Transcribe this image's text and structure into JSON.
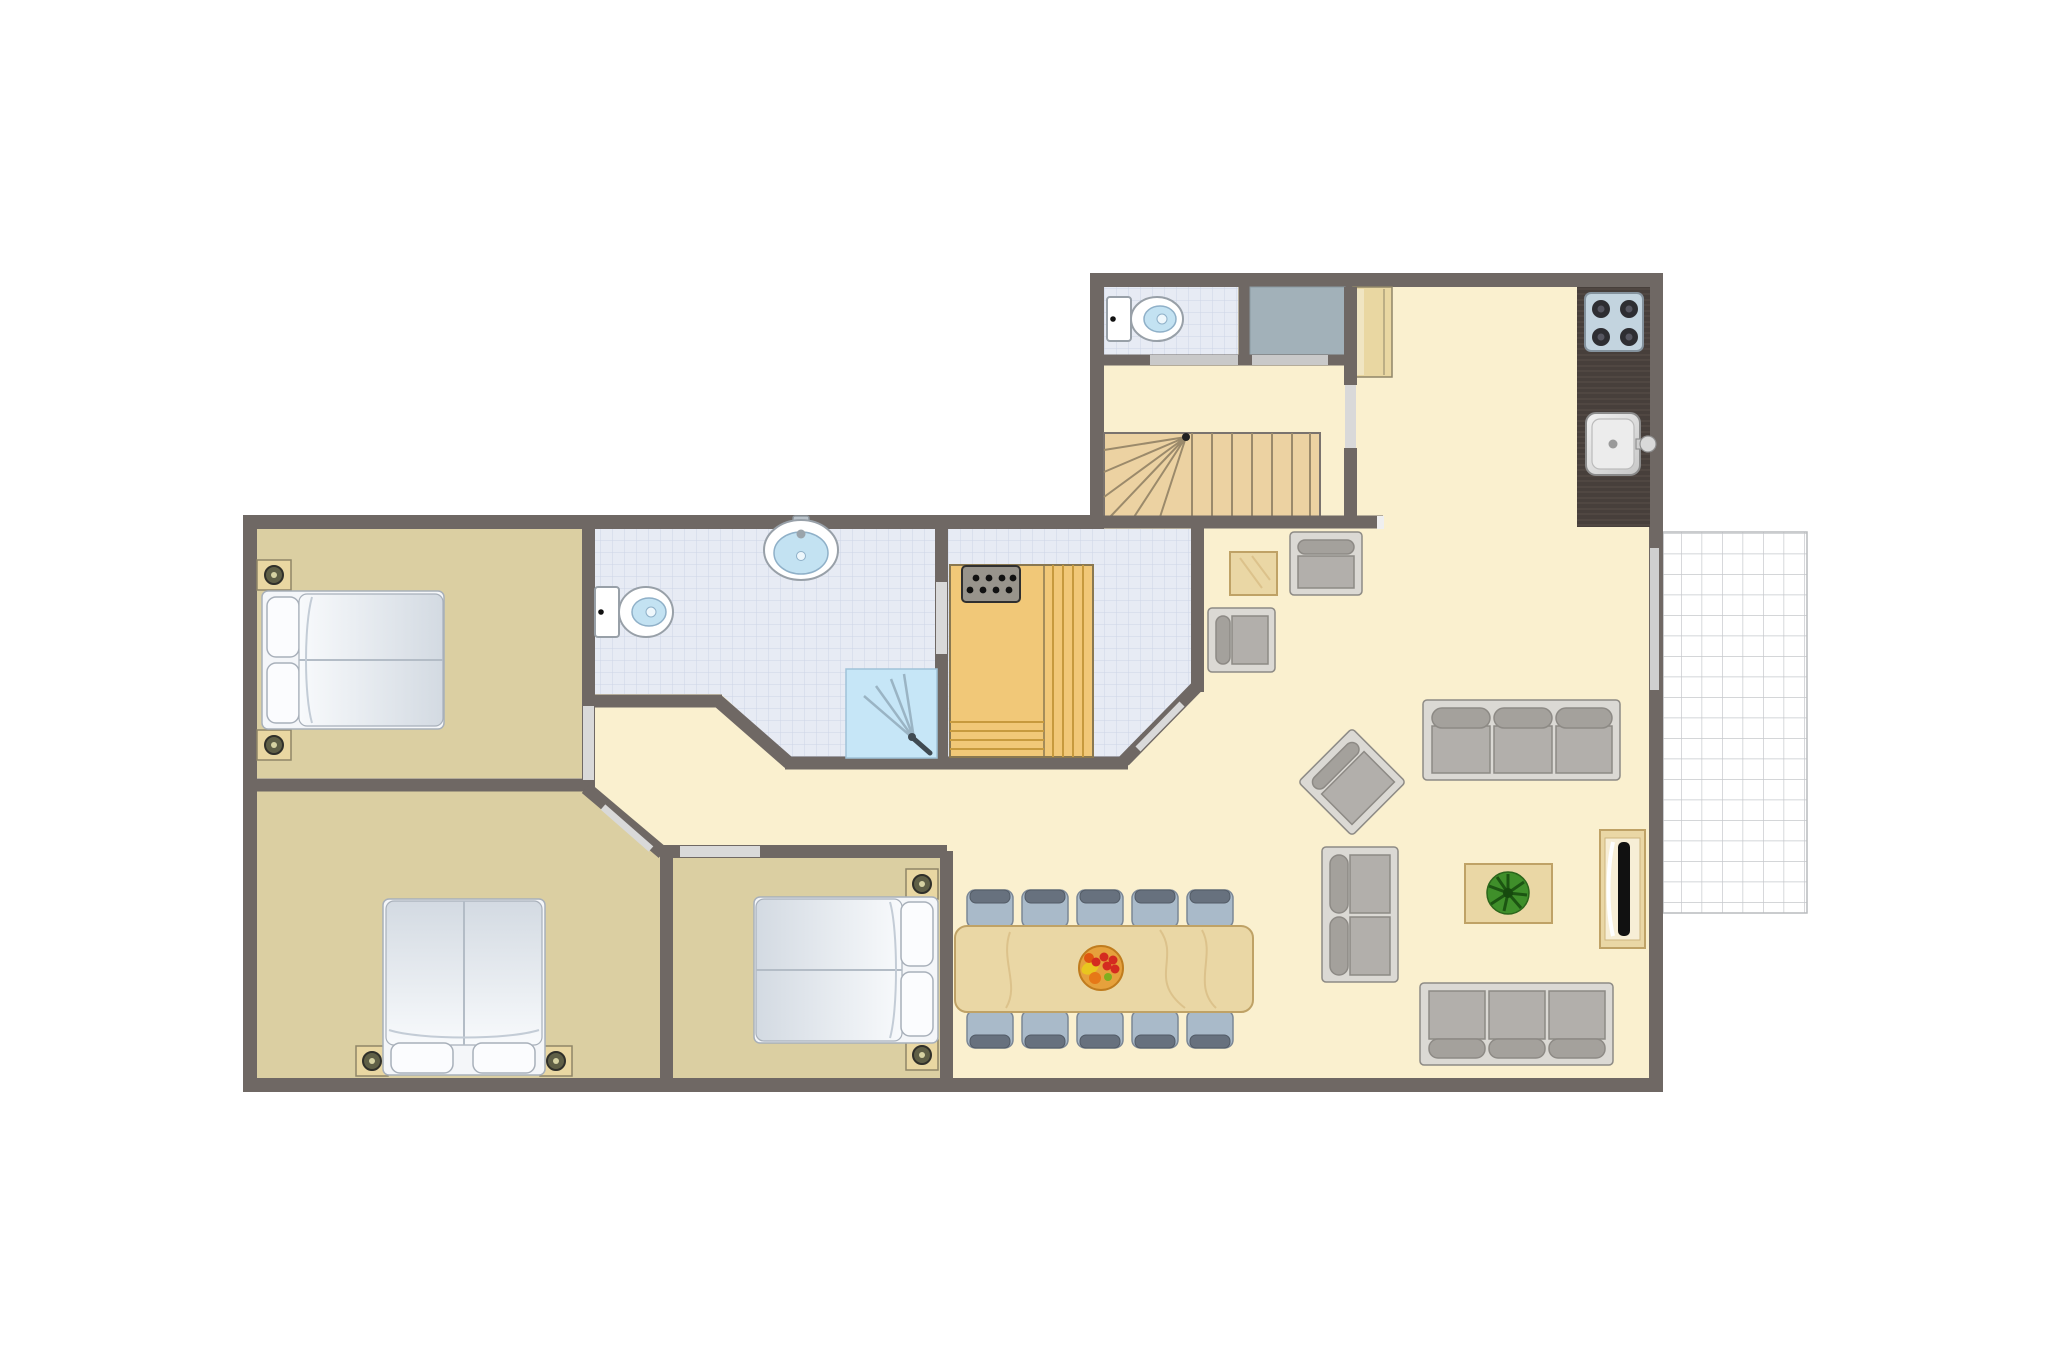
{
  "colors": {
    "wall": "#6f6864",
    "floor_cream": "#faf0cf",
    "floor_tan": "#dbcfa2",
    "tile": "#e7ebf4",
    "tile_line": "#cdd5e6",
    "shower": "#c6e6f7",
    "fixture_blue": "#c3e2f2",
    "storage": "#a2b1b9",
    "sauna_wood": "#f1c878",
    "sauna_slat": "#c79a3e",
    "stairs_wood": "#ecd2a2",
    "stairs_line": "#9b8a6b",
    "counter": "#473f3b",
    "stove": "#c3d4df",
    "furniture_wood": "#ead7a5",
    "wood_edge": "#bfa266",
    "sofa_frame": "#dbd9d4",
    "sofa_seat": "#b2afab",
    "sofa_back": "#a4a19c",
    "sofa_edge": "#8d8a85",
    "chair_seat": "#a9bac9",
    "chair_back": "#67717e",
    "chair_edge": "#7b8795",
    "plant": "#3f8f2a",
    "plant_dark": "#1c5512",
    "door_light": "#d9d9d9",
    "threshold": "#c9c9c9",
    "terrace_line": "#c6c8cc",
    "bed_white": "#f4f6f9",
    "bed_shade": "#d3dae2",
    "bed_edge": "#a8b0ba",
    "lamp": "#5f5f46",
    "lamp_dot": "#d6d2a2",
    "nightstand": "#e9d7a2",
    "nightstand_edge": "#8f8668",
    "fruit_bowl": "#e6a13c",
    "fruit_bowl_edge": "#c07c1e",
    "fruit_red": "#d42b20",
    "fruit_yellow": "#e9c61f",
    "fruit_orange": "#e67817",
    "fruit_green": "#7fae1f"
  },
  "floorplan": {
    "type": "apartment-floor-plan-top-view",
    "rooms": [
      {
        "id": "bedroom-top-left",
        "floor": "tan",
        "furniture": [
          "double-bed",
          "nightstand",
          "nightstand"
        ]
      },
      {
        "id": "bedroom-bottom-left",
        "floor": "tan",
        "furniture": [
          "double-bed",
          "nightstand",
          "nightstand"
        ]
      },
      {
        "id": "bedroom-middle",
        "floor": "tan",
        "furniture": [
          "double-bed",
          "nightstand",
          "nightstand"
        ]
      },
      {
        "id": "bathroom",
        "floor": "tile",
        "fixtures": [
          "toilet",
          "washbasin",
          "shower"
        ]
      },
      {
        "id": "sauna-room",
        "floor": "tile",
        "fixtures": [
          "sauna-cabin",
          "sauna-heater"
        ]
      },
      {
        "id": "wc",
        "floor": "tile",
        "fixtures": [
          "toilet"
        ]
      },
      {
        "id": "storage-closet",
        "floor": "gray"
      },
      {
        "id": "hall",
        "fixtures": [
          "winder-staircase"
        ]
      },
      {
        "id": "kitchen",
        "fixtures": [
          "counter",
          "hob-4-burners",
          "sink",
          "tall-cabinet"
        ]
      },
      {
        "id": "living-dining",
        "furniture": [
          "sofa-3-seat",
          "sofa-3-seat",
          "sofa-2-seat",
          "armchair",
          "armchair",
          "armchair-rotated",
          "coffee-table",
          "plant",
          "tv-sideboard",
          "side-table",
          "dining-table",
          "fruit-bowl"
        ]
      },
      {
        "id": "terrace",
        "floor": "grid-tiles"
      }
    ],
    "counts": {
      "dining_chairs": 10,
      "sofas": 3,
      "armchairs": 3,
      "beds": 3,
      "toilets": 2
    }
  }
}
